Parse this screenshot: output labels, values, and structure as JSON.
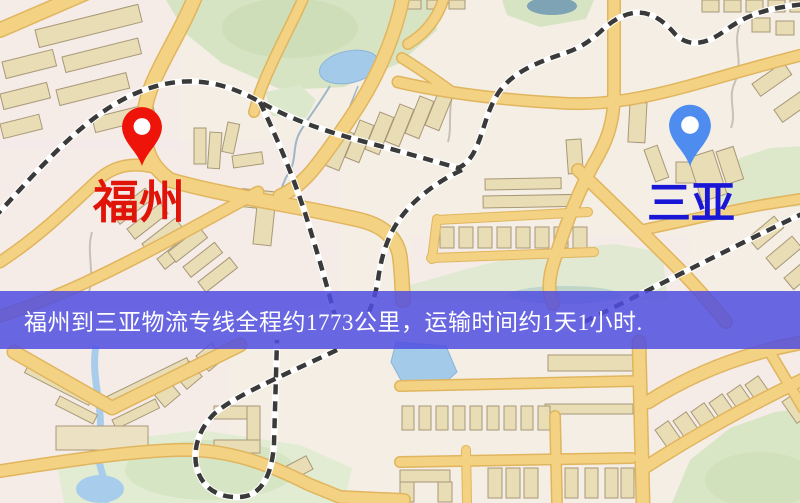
{
  "map": {
    "origin": {
      "name": "福州",
      "pin_icon": "red-location-pin",
      "pin_color": "#ee1409",
      "label_color": "#e01408"
    },
    "destination": {
      "name": "三亚",
      "pin_icon": "blue-location-pin",
      "pin_color": "#4e8cf0",
      "label_color": "#1a16d6"
    },
    "palette": {
      "land": "#f4eee4",
      "road": "#f4d283",
      "road_casing": "#e0b55e",
      "water": "#a4cae9",
      "park": "#d7e4c4",
      "building": "#e9ddb6",
      "railway_dark": "#3a3a3a",
      "railway_light": "#ffffff"
    }
  },
  "banner": {
    "text": "福州到三亚物流专线全程约1773公里，运输时间约1天1小时.",
    "bg_color": "#504ee1",
    "text_color": "#ffffff",
    "distance_km": "1773",
    "duration": "1天1小时"
  }
}
